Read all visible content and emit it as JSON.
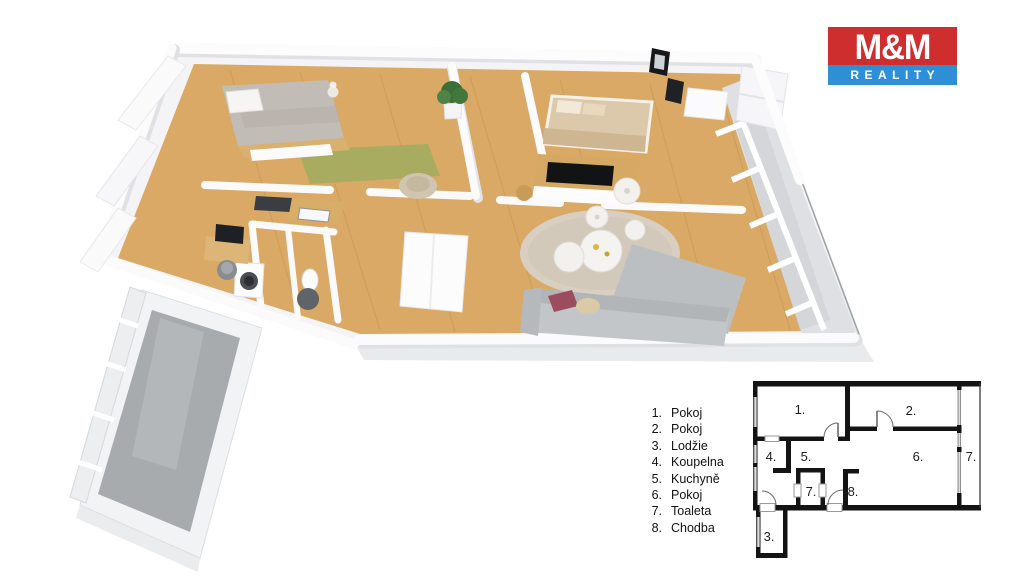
{
  "logo": {
    "title": "M&M",
    "subtitle": "REALITY",
    "brand_red": "#cf2e2e",
    "brand_blue": "#2f8fd6"
  },
  "legend": {
    "items": [
      {
        "num": "1.",
        "label": "Pokoj"
      },
      {
        "num": "2.",
        "label": "Pokoj"
      },
      {
        "num": "3.",
        "label": "Lodžie"
      },
      {
        "num": "4.",
        "label": "Koupelna"
      },
      {
        "num": "5.",
        "label": "Kuchyně"
      },
      {
        "num": "6.",
        "label": "Pokoj"
      },
      {
        "num": "7.",
        "label": "Toaleta"
      },
      {
        "num": "8.",
        "label": "Chodba"
      }
    ]
  },
  "plan2d": {
    "labels": {
      "room1": "1.",
      "room2": "2.",
      "room3": "3.",
      "room4": "4.",
      "room5": "5.",
      "room6": "6.",
      "room7_toilet": "7.",
      "room8": "8.",
      "room7_right": "7."
    }
  },
  "render3d": {
    "description": "3D rendered isometric floor plan of the apartment",
    "wood_floor_color": "#d9a965",
    "loggia_floor_color": "#a7abae",
    "wall_color": "#ffffff"
  }
}
